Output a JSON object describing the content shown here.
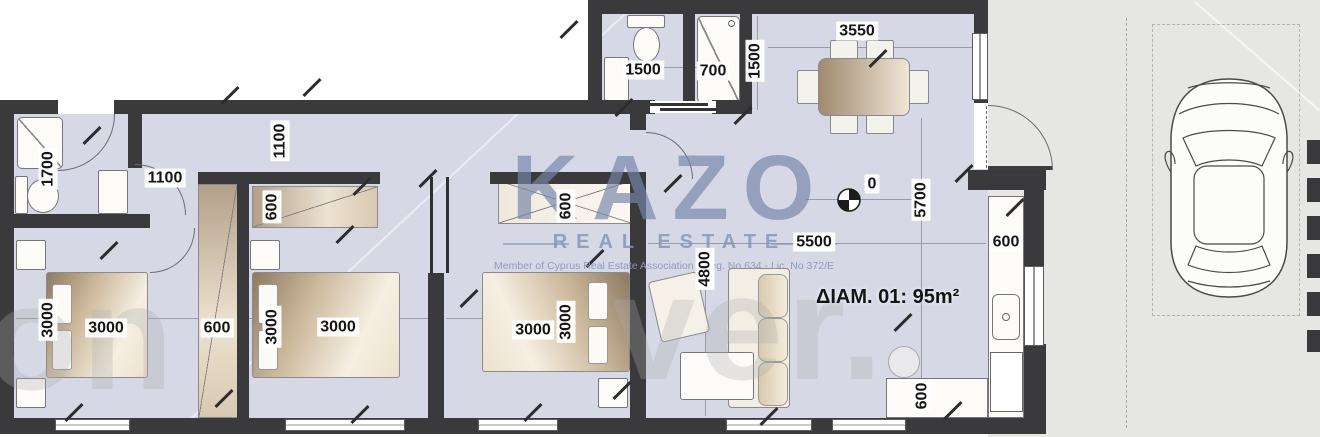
{
  "plan": {
    "apartment_label": "ΔΙΑΜ. 01: 95m²",
    "level_marker_value": "0"
  },
  "branding": {
    "logo_text": "KAZO",
    "logo_subtitle": "REAL ESTATE",
    "membership_line": "Member of Cyprus Real Estate Association",
    "registration_line": "Reg. No.634 - Lic. No 372/E"
  },
  "background_watermark": {
    "left_fragment": "on",
    "right_fragment": "ver."
  },
  "dimensions": [
    {
      "value": "1500",
      "x": 643,
      "y": 70,
      "vertical": false
    },
    {
      "value": "700",
      "x": 713,
      "y": 71,
      "vertical": false
    },
    {
      "value": "1500",
      "x": 755,
      "y": 61,
      "vertical": true
    },
    {
      "value": "3550",
      "x": 857,
      "y": 31,
      "vertical": false
    },
    {
      "value": "1700",
      "x": 48,
      "y": 169,
      "vertical": true
    },
    {
      "value": "1100",
      "x": 165,
      "y": 178,
      "vertical": false
    },
    {
      "value": "1100",
      "x": 280,
      "y": 141,
      "vertical": true
    },
    {
      "value": "600",
      "x": 272,
      "y": 207,
      "vertical": true
    },
    {
      "value": "600",
      "x": 217,
      "y": 328,
      "vertical": false
    },
    {
      "value": "3000",
      "x": 48,
      "y": 320,
      "vertical": true
    },
    {
      "value": "3000",
      "x": 106,
      "y": 328,
      "vertical": false
    },
    {
      "value": "3000",
      "x": 272,
      "y": 327,
      "vertical": true
    },
    {
      "value": "3000",
      "x": 338,
      "y": 327,
      "vertical": false
    },
    {
      "value": "600",
      "x": 566,
      "y": 206,
      "vertical": true
    },
    {
      "value": "3000",
      "x": 533,
      "y": 330,
      "vertical": false
    },
    {
      "value": "3000",
      "x": 566,
      "y": 322,
      "vertical": true
    },
    {
      "value": "4800",
      "x": 705,
      "y": 269,
      "vertical": true
    },
    {
      "value": "5500",
      "x": 814,
      "y": 242,
      "vertical": false
    },
    {
      "value": "0",
      "x": 872,
      "y": 184,
      "vertical": false
    },
    {
      "value": "5700",
      "x": 921,
      "y": 200,
      "vertical": true
    },
    {
      "value": "600",
      "x": 1006,
      "y": 242,
      "vertical": false
    },
    {
      "value": "600",
      "x": 922,
      "y": 396,
      "vertical": true
    }
  ],
  "colors": {
    "wall": "#3a3a3c",
    "floor": "#d6d8e5",
    "parking_area": "#e6e6e4",
    "logo_blue": "#7d8fb0",
    "furniture_tan": "#cbb79a",
    "label_text": "#151515"
  }
}
